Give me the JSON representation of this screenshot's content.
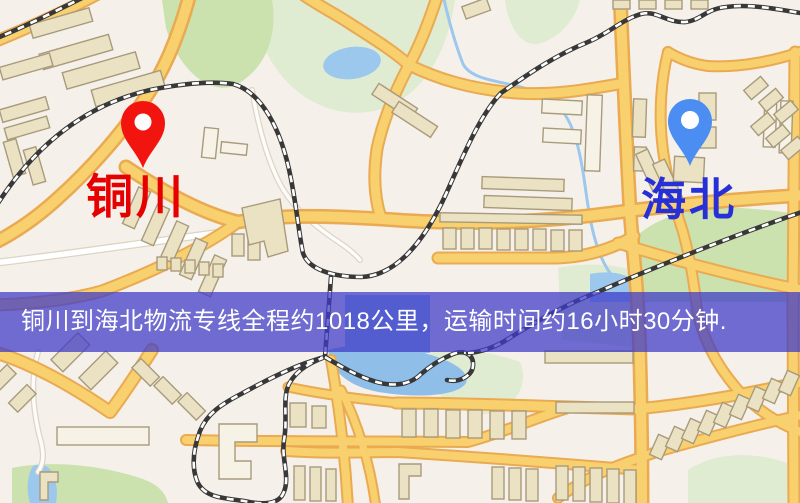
{
  "markers": {
    "origin": {
      "name": "铜川"
    },
    "destination": {
      "name": "海北"
    }
  },
  "banner": {
    "text": "铜川到海北物流专线全程约1018公里，运输时间约16小时30分钟."
  },
  "map_features": {
    "road_type_major": "yellow-road",
    "road_type_minor": "white-road",
    "railway": "black-white-dashed-railway",
    "park": "green-area",
    "water": "lake-pond",
    "building": "tan-building-block"
  },
  "theme": {
    "map_background": "#f5f1ea",
    "park_green": "#cbe2ae",
    "park_pale": "#e0ecd2",
    "water_blue": "#9cc8ee",
    "water_deep": "#8fbfe9",
    "road_fill": "#f8d06e",
    "road_casing": "#eaaa52",
    "stream_casing": "#dcd5c6",
    "building_fill": "#ebe1c3",
    "building_outline": "#a89b7c",
    "building_white": "#f6f2e6",
    "railway_dark": "#383838",
    "railway_dash": "#ffffff",
    "pin_origin": "#f2150f",
    "pin_origin_label": "#e60000",
    "pin_destination": "#4c8df2",
    "pin_destination_label": "#2730d6",
    "banner_background": "rgba(64,60,200,0.74)",
    "banner_text": "#ffffff"
  }
}
